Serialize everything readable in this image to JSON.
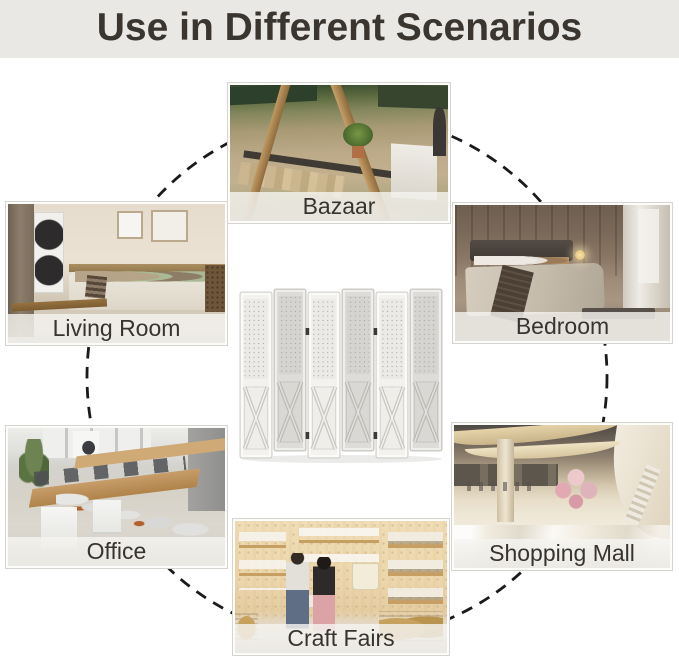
{
  "title": "Use in Different Scenarios",
  "scenarios": [
    {
      "name": "bazaar",
      "label": "Bazaar"
    },
    {
      "name": "living-room",
      "label": "Living Room"
    },
    {
      "name": "bedroom",
      "label": "Bedroom"
    },
    {
      "name": "office",
      "label": "Office"
    },
    {
      "name": "shopping-mall",
      "label": "Shopping Mall"
    },
    {
      "name": "craft-fairs",
      "label": "Craft Fairs"
    }
  ],
  "product": {
    "description": "6-panel whitewashed wood folding room divider with pegboard tops and X-brace bottoms",
    "panel_count": 6
  },
  "colors": {
    "background": "#ffffff",
    "title_bar_bg": "#e9e8e5",
    "title_text": "#3a362f",
    "caption_bg": "rgba(240,238,234,0.88)",
    "caption_text": "#37342f",
    "connector": "#1a1a1a"
  }
}
